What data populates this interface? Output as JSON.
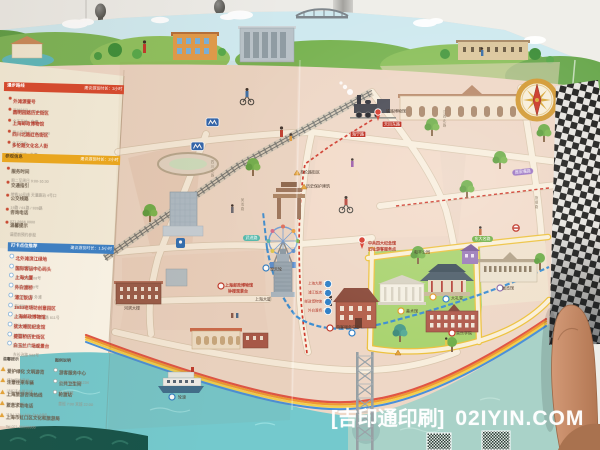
{
  "watermark": {
    "brand": "[吉印通印刷]",
    "domain": "02IYIN.COM"
  },
  "panel": {
    "sec1": {
      "title": "漫步路线",
      "banner": "建议游览时长：3小时",
      "items": [
        {
          "label": "外滩源壹号",
          "sub": "开放时间 9:00-17:00"
        },
        {
          "label": "圆明园路历史街区",
          "sub": "全天开放 · 免费"
        },
        {
          "label": "上海邮政博物馆",
          "sub": "周三至周日 9:00-16:00"
        },
        {
          "label": "四川北路红色街区",
          "sub": "全天开放"
        },
        {
          "label": "多伦路文化名人街",
          "sub": "全天开放 · 免费"
        }
      ]
    },
    "sec2": {
      "title": "参观信息",
      "banner": "建议游览时长：2小时",
      "groups": [
        {
          "label": "服务时间",
          "sub": "周二至周日 9:00-16:30"
        },
        {
          "label": "交通指引",
          "sub": "地铁10号线 天潼路站 4号口"
        },
        {
          "label": "公交线路",
          "sub": "19路 / 61路 / 939路"
        },
        {
          "label": "咨询电话",
          "sub": "021-5666 0000"
        },
        {
          "label": "温馨提示",
          "sub": "请提前预约参观"
        }
      ]
    },
    "sec3": {
      "title": "打卡点位推荐",
      "banner": "建议游览时长：1.5小时",
      "items": [
        {
          "label": "北外滩滨江绿地",
          "sub": "东大名路 500号"
        },
        {
          "label": "国际客运中心码头",
          "sub": "东大名路 908号"
        },
        {
          "label": "上海大厦",
          "sub": "北苏州路 20号"
        },
        {
          "label": "外白渡桥",
          "sub": "中山东一路 外滩"
        },
        {
          "label": "浦江饭店",
          "sub": "黄浦路 15号"
        },
        {
          "label": "1933老场坊创意园区",
          "sub": "沙泾路 10号 · 溧阳路 611号"
        },
        {
          "label": "上海邮政博物馆",
          "sub": "北苏州路 250号"
        },
        {
          "label": "犹太难民纪念馆",
          "sub": "长阳路 62号"
        },
        {
          "label": "提篮桥历史街区",
          "sub": "霍山路 · 舟山路"
        },
        {
          "label": "白玉兰广场观景台",
          "sub": "东长治路 588号"
        }
      ]
    },
    "notes": {
      "left_title": "温馨提示",
      "left": [
        {
          "label": "爱护绿化 文明游览",
          "sub": "请勿踩踏草坪"
        },
        {
          "label": "注意往来车辆",
          "sub": "过街请走斑马线"
        },
        {
          "label": "上海旅游咨询热线",
          "sub": "Tel 962020"
        },
        {
          "label": "紧急求助电话",
          "sub": "110 / 120 / 119（24小时）"
        },
        {
          "label": "上海市虹口区文化和旅游局",
          "sub": "Tel 021-56666666"
        }
      ],
      "right_title": "图例说明",
      "right": [
        {
          "label": "游客服务中心",
          "sub": "Tel 021-56661234"
        },
        {
          "label": "公共卫生间",
          "sub": "全天开放"
        },
        {
          "label": "轮渡站",
          "sub": "首班 7:00 末班 22:00"
        }
      ]
    }
  },
  "map": {
    "labels": [
      {
        "t": "铁路博物馆",
        "x": 386,
        "y": 109,
        "c": "lbl"
      },
      {
        "t": "天目东路",
        "x": 382,
        "y": 121,
        "c": "plate"
      },
      {
        "t": "海宁路",
        "x": 350,
        "y": 131,
        "c": "plate"
      },
      {
        "t": "武进路",
        "x": 243,
        "y": 235,
        "c": "ovteal"
      },
      {
        "t": "周家嘴路",
        "x": 512,
        "y": 170,
        "c": "ovpurple"
      },
      {
        "t": "东大名路",
        "x": 472,
        "y": 236,
        "c": "ovgreen"
      },
      {
        "t": "多伦路街区",
        "x": 300,
        "y": 170,
        "c": "lbl"
      },
      {
        "t": "历史保护建筑",
        "x": 306,
        "y": 184,
        "c": "lbl"
      },
      {
        "t": "摩天轮",
        "x": 270,
        "y": 267,
        "c": "lbl"
      },
      {
        "t": "中共四大纪念馆",
        "x": 368,
        "y": 241,
        "c": "lblr"
      },
      {
        "t": "旧址游客服务点",
        "x": 368,
        "y": 247,
        "c": "lblr"
      },
      {
        "t": "上海邮政博物馆",
        "x": 225,
        "y": 283,
        "c": "lblr"
      },
      {
        "t": "钟楼观景台",
        "x": 228,
        "y": 289,
        "c": "lblr"
      },
      {
        "t": "上海大厦",
        "x": 255,
        "y": 297,
        "c": "lbl"
      },
      {
        "t": "河滨大楼",
        "x": 124,
        "y": 306,
        "c": "lbl"
      },
      {
        "t": "游客服务中心",
        "x": 336,
        "y": 325,
        "c": "lbl"
      },
      {
        "t": "美术馆",
        "x": 406,
        "y": 309,
        "c": "lbl"
      },
      {
        "t": "大礼堂",
        "x": 451,
        "y": 296,
        "c": "lbl"
      },
      {
        "t": "音乐学院",
        "x": 456,
        "y": 331,
        "c": "lbl"
      },
      {
        "t": "展览馆",
        "x": 502,
        "y": 286,
        "c": "lbl"
      },
      {
        "t": "轮渡",
        "x": 178,
        "y": 395,
        "c": "lbl"
      },
      {
        "t": "和平公园",
        "x": 414,
        "y": 250,
        "c": "lbl"
      },
      {
        "t": "四川北路",
        "x": 210,
        "y": 160,
        "c": "vst"
      },
      {
        "t": "吴淞路",
        "x": 240,
        "y": 198,
        "c": "vst"
      },
      {
        "t": "江西北路",
        "x": 442,
        "y": 110,
        "c": "vst"
      },
      {
        "t": "旅顺路",
        "x": 534,
        "y": 196,
        "c": "vst"
      }
    ],
    "stops": [
      {
        "n": "1",
        "t": "上海大厦"
      },
      {
        "n": "2",
        "t": "浦江饭店"
      },
      {
        "n": "3",
        "t": "邮政博物馆"
      },
      {
        "n": "4",
        "t": "外白渡桥"
      }
    ]
  }
}
